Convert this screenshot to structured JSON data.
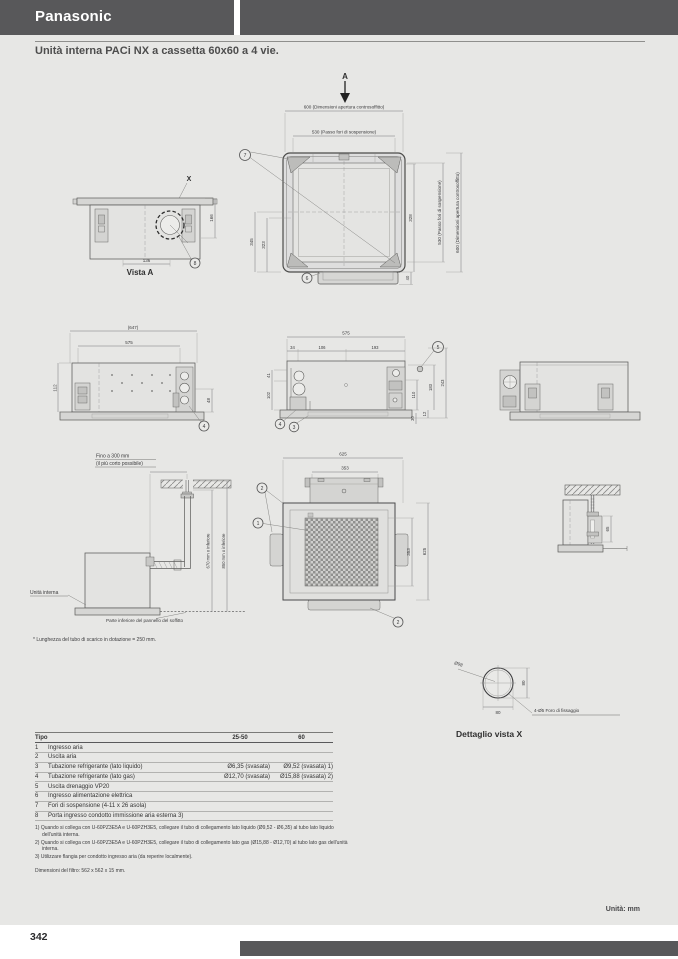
{
  "brand": "Panasonic",
  "title": "Unità interna PACi NX a cassetta 60x60 a 4 vie.",
  "footer": {
    "page_number": "342",
    "units": "Unità: mm"
  },
  "drawings": {
    "top_view": {
      "section_label": "A",
      "dim_opening_top": "600 (Dimensioni apertura controsoffitto)",
      "dim_pitch_top": "530 (Passo fori di sospensione)",
      "dim_pitch_right": "530 (Passo fori di sospensione)",
      "dim_opening_right": "600 (Dimensioni apertura controsoffitto)",
      "dim_345": "345",
      "dim_323": "323",
      "dim_328": "328",
      "dim_40": "40",
      "callout_7": "7",
      "callout_6": "6"
    },
    "vista_a": {
      "title": "Vista A",
      "detail_mark": "X",
      "dim_136": "136",
      "dim_166": "166",
      "callout_8": "8"
    },
    "side_left": {
      "dim_647": "(647)",
      "dim_575": "575",
      "dim_112": "112",
      "dim_48": "48",
      "callout_4": "4"
    },
    "side_center": {
      "dim_575": "575",
      "dim_34": "34",
      "dim_106": "106",
      "dim_193": "193",
      "dim_41": "41",
      "dim_102": "102",
      "dim_110": "110",
      "dim_183": "183",
      "dim_243": "243",
      "dim_12": "12",
      "dim_30": "30",
      "callout_5": "5",
      "callout_4": "4",
      "callout_3": "3"
    },
    "drain": {
      "note_line1": "Fino a 300 mm",
      "note_line2": "(il più corto possibile)",
      "riser_outer": "850 mm o inferiore",
      "riser_inner": "670 mm o inferiore",
      "unit_label": "Unità interna",
      "ceiling_label": "Parte inferiore del pannello del soffitto",
      "footnote": "* Lunghezza del tubo di scarico in dotazione = 250 mm."
    },
    "panel_view": {
      "dim_625_top": "625",
      "dim_353_top": "353",
      "dim_353_right": "353",
      "dim_625_right": "625",
      "callout_1": "1",
      "callout_2a": "2",
      "callout_2b": "2"
    },
    "bracket_detail": {
      "dim_65": "65"
    },
    "detail_x": {
      "title": "Dettaglio vista X",
      "dim_diameter": "Ø98",
      "dim_80_right": "80",
      "dim_80_bottom": "80",
      "hole_note": "4-Ø5 Foro di fissaggio"
    }
  },
  "table": {
    "headers": [
      "Tipo",
      "25-50",
      "60"
    ],
    "rows": [
      {
        "num": "1",
        "label": "Ingresso aria",
        "v1": "",
        "v2": ""
      },
      {
        "num": "2",
        "label": "Uscita aria",
        "v1": "",
        "v2": ""
      },
      {
        "num": "3",
        "label": "Tubazione refrigerante (lato liquido)",
        "v1": "Ø6,35 (svasata)",
        "v2": "Ø9,52 (svasata) 1)"
      },
      {
        "num": "4",
        "label": "Tubazione refrigerante (lato gas)",
        "v1": "Ø12,70 (svasata)",
        "v2": "Ø15,88 (svasata) 2)"
      },
      {
        "num": "5",
        "label": "Uscita drenaggio VP20",
        "v1": "",
        "v2": ""
      },
      {
        "num": "6",
        "label": "Ingresso alimentazione elettrica",
        "v1": "",
        "v2": ""
      },
      {
        "num": "7",
        "label": "Fori di sospensione (4-11 x 26 asola)",
        "v1": "",
        "v2": ""
      },
      {
        "num": "8",
        "label": "Porta ingresso condotto immissione aria esterna 3)",
        "v1": "",
        "v2": ""
      }
    ],
    "footnotes": [
      "1) Quando si collega con U-60PZ3E5A e U-60PZH3E5, collegare il tubo di collegamento lato liquido (Ø9,52 - Ø6,35) al tubo lato liquido dell'unità interna.",
      "2) Quando si collega con U-60PZ3E5A e U-60PZH3E5, collegare il tubo di collegamento lato gas (Ø15,88 - Ø12,70) al tubo lato gas dell'unità interna.",
      "3) Utilizzare flangia per condotto ingresso aria (da reperire localmente)."
    ],
    "filter_note": "Dimensioni del filtro: 562 x 562 x 15 mm."
  }
}
